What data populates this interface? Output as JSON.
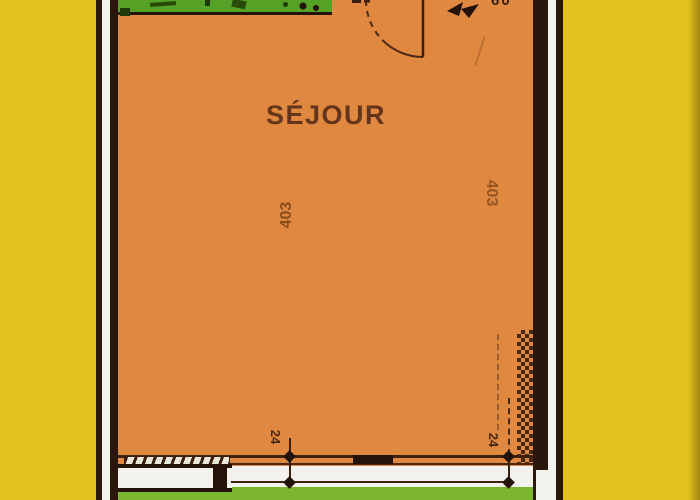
{
  "plan": {
    "room": {
      "label": "SÉJOUR"
    },
    "dimensions": {
      "height_left": "403",
      "height_right": "403",
      "offset_left": "24",
      "offset_right": "24",
      "top_cutoff": "60"
    },
    "colors": {
      "background_yellow": "#e4c21e",
      "room_orange": "#e08840",
      "balcony_green_top": "#55a226",
      "balcony_green_bottom": "#7cb52e",
      "wall_dark": "#2a160c",
      "wall_core_white": "#f3f1ec",
      "ink_brown": "#3a1f0c",
      "label_brown": "#64351a"
    }
  }
}
